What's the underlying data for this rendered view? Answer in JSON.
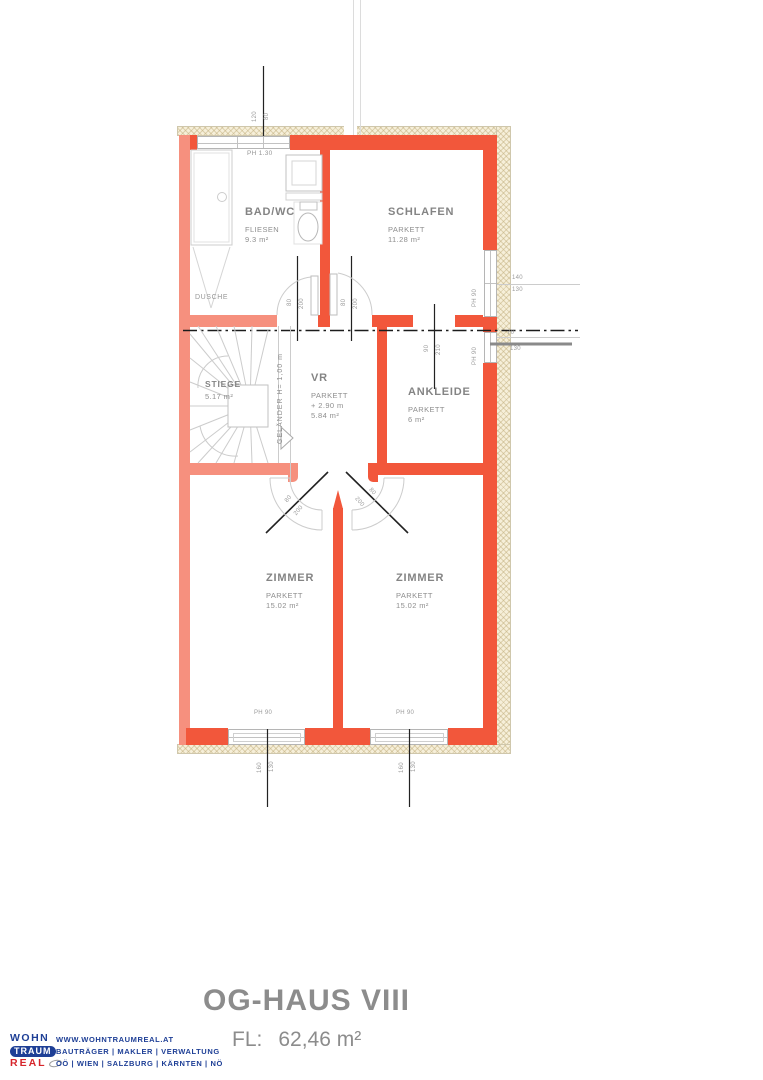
{
  "colors": {
    "wall_primary": "#F2573B",
    "wall_secondary": "#F6907E",
    "insulation": "#F6EFD9",
    "logo_blue": "#1E3F96",
    "logo_red": "#D6252B",
    "text_gray": "#8C8C8C"
  },
  "plan": {
    "rooms": {
      "badwc": {
        "name": "BAD/WC",
        "floor": "FLIESEN",
        "area": "9.3 m²"
      },
      "schlafen": {
        "name": "SCHLAFEN",
        "floor": "PARKETT",
        "area": "11.28 m²"
      },
      "stiege": {
        "name": "STIEGE",
        "area": "5.17 m²"
      },
      "vr": {
        "name": "VR",
        "floor": "PARKETT",
        "level": "+ 2.90 m",
        "area": "5.84 m²"
      },
      "ankleide": {
        "name": "ANKLEIDE",
        "floor": "PARKETT",
        "area": "6 m²"
      },
      "zimmer1": {
        "name": "ZIMMER",
        "floor": "PARKETT",
        "area": "15.02 m²"
      },
      "zimmer2": {
        "name": "ZIMMER",
        "floor": "PARKETT",
        "area": "15.02 m²"
      }
    },
    "labels": {
      "dusche": "DUSCHE",
      "gelaender": "GELÄNDER H= 1,00 m",
      "ph130": "PH 1.30",
      "ph90": "PH 90"
    },
    "dims": {
      "top": {
        "a": "120",
        "b": "80"
      },
      "door": {
        "w": "80",
        "h": "200"
      },
      "ankleide_door": {
        "w": "90",
        "h": "210"
      },
      "right_upper": {
        "a": "140",
        "b": "130"
      },
      "right_lower": {
        "a": "70",
        "b": "130"
      },
      "bottom": {
        "a": "160",
        "b": "130"
      }
    }
  },
  "footer": {
    "title": "OG-HAUS VIII",
    "area_label": "FL:",
    "area_value": "62,46 m²",
    "logo": {
      "line1": "WOHN",
      "line2": "TRAUM",
      "line3": "REAL"
    },
    "info": {
      "website": "WWW.WOHNTRAUMREAL.AT",
      "services": "BAUTRÄGER | MAKLER | VERWALTUNG",
      "regions": "OÖ | WIEN | SALZBURG | KÄRNTEN | NÖ"
    }
  }
}
